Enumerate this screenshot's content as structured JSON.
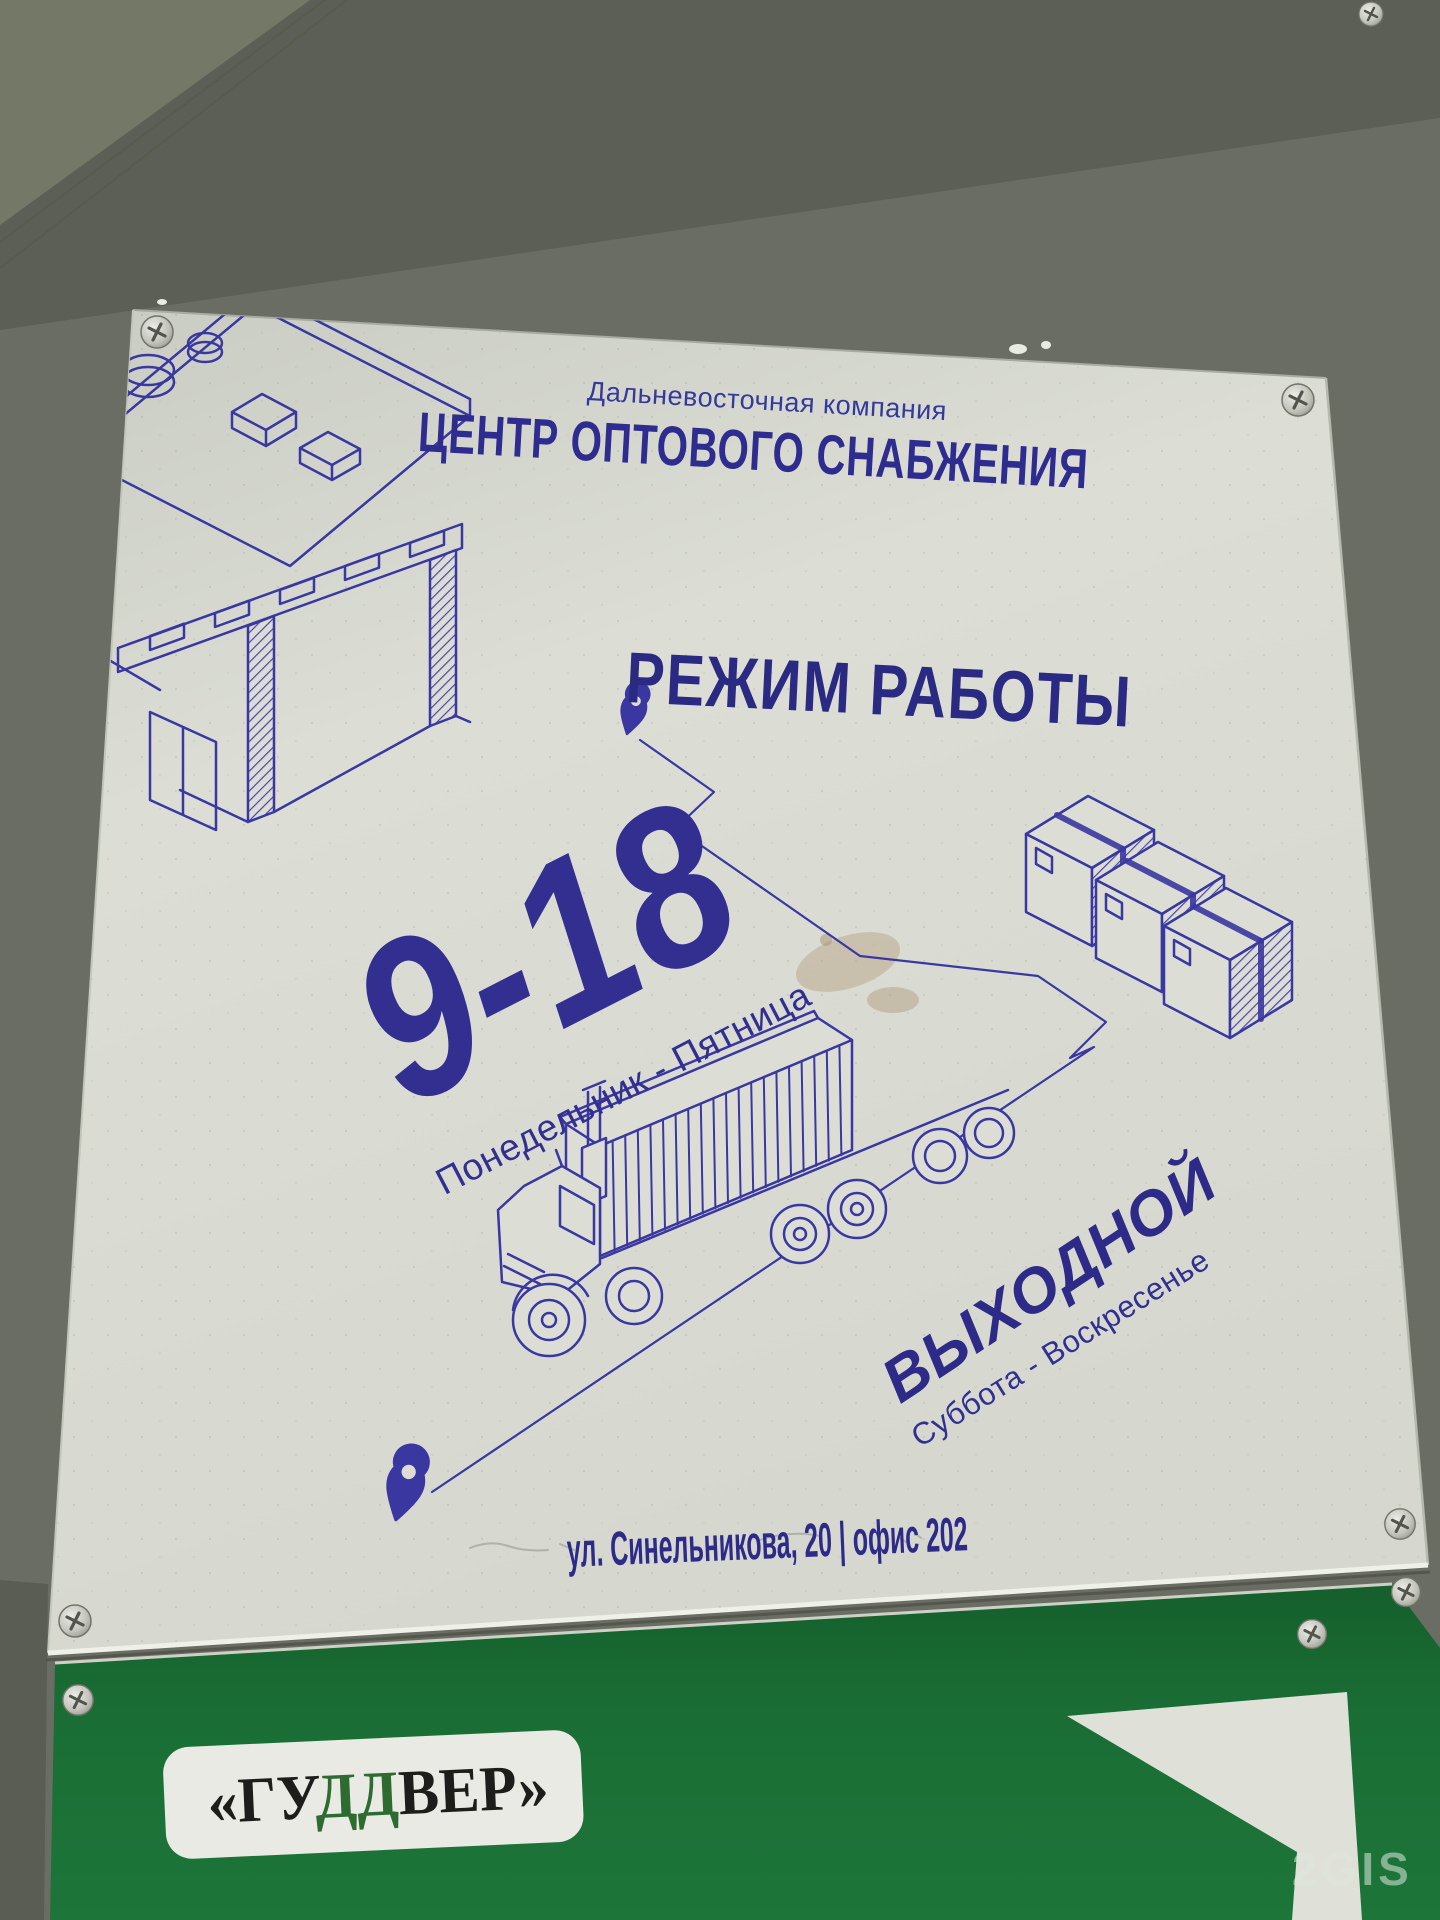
{
  "photo": {
    "description": "Photo of an outdoor working-hours sign on a gray wall with a green dealer sign below"
  },
  "top_sign": {
    "company_small": "Дальневосточная компания",
    "company_title": "ЦЕНТР ОПТОВОГО СНАБЖЕНИЯ",
    "heading": "РЕЖИМ РАБОТЫ",
    "hours": "9-18",
    "weekdays": "Понедельник - Пятница",
    "closed": "ВЫХОДНОЙ",
    "weekend": "Суббота - Воскресенье",
    "address": "ул. Синельникова, 20 | офис 202"
  },
  "bottom_sign": {
    "brand_part1": "«ГУ",
    "brand_part2": "ДД",
    "brand_part3": "ВЕР»"
  },
  "watermark": {
    "label": "2GIS"
  },
  "icons": {
    "map-pin-icon": "teardrop location marker",
    "screw-icon": "phillips screw head",
    "warehouse-illustration": "isometric blueprint warehouse line art",
    "truck-illustration": "isometric container truck line art",
    "parcel-boxes-illustration": "three isometric parcel boxes",
    "arrow-shape": "white angular arrow on green sign"
  },
  "colors": {
    "ink": "#302d8c",
    "paper": "#dcded6",
    "wall": "#6a6d63",
    "green_sign": "#1a6e35",
    "brand_green": "#2e6b30",
    "brand_black": "#1d1d1b"
  }
}
